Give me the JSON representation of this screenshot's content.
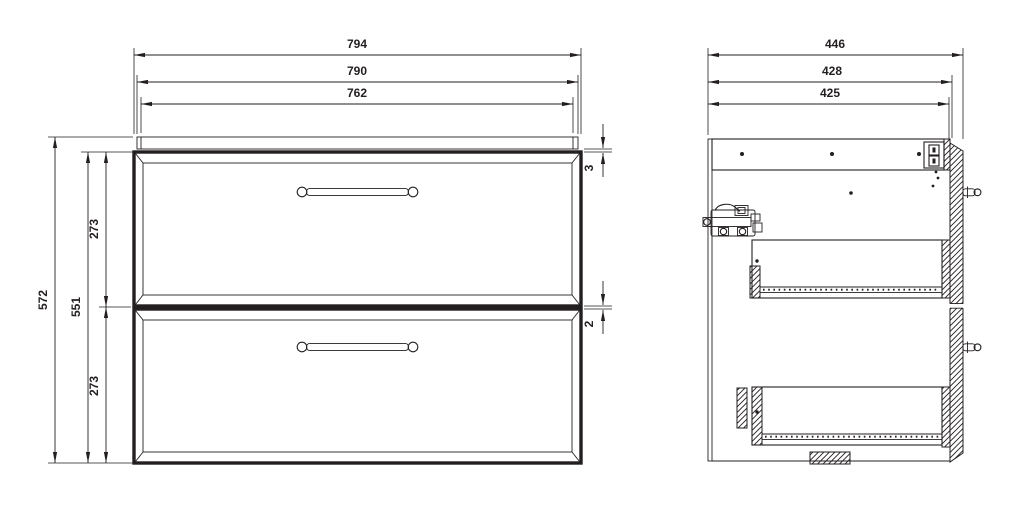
{
  "drawing": {
    "background": "#ffffff",
    "line_color": "#231f20",
    "front_view": {
      "dims": {
        "overall_width": "794",
        "carcass_width": "790",
        "face_width": "762",
        "overall_height": "572",
        "front_height": "551",
        "drawer1_height": "273",
        "drawer2_height": "273",
        "top_reveal": "3",
        "drawer_gap": "2"
      }
    },
    "side_view": {
      "dims": {
        "overall_depth": "446",
        "carcass_depth": "428",
        "inner_depth": "425"
      }
    }
  }
}
